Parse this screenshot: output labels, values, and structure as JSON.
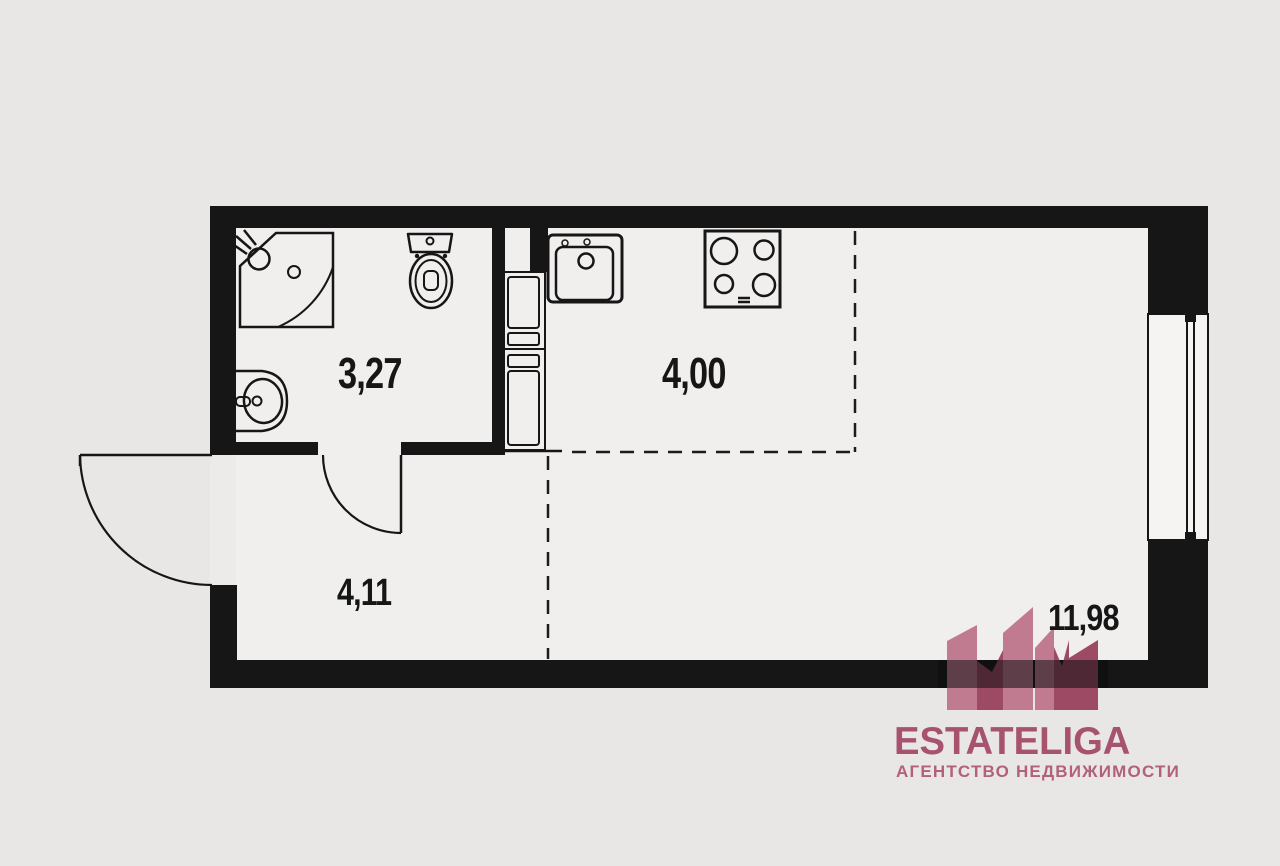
{
  "plan": {
    "title": "studio-apartment-floor-plan",
    "rooms": {
      "bathroom": {
        "area_label": "3,27"
      },
      "kitchen": {
        "area_label": "4,00"
      },
      "hallway": {
        "area_label": "4,11"
      },
      "living": {
        "area_label": "11,98"
      }
    },
    "fixtures": [
      "corner-shower",
      "pedestal-sink",
      "toilet",
      "laundry-closet",
      "kitchen-sink",
      "stove-4-burner",
      "window",
      "entry-door",
      "bathroom-door"
    ],
    "colors": {
      "wall": "#161616",
      "floor": "#f0efee",
      "background": "#e8e7e6",
      "line": "#1c1c1c"
    }
  },
  "logo": {
    "brand": "ESTATELIGA",
    "tagline": "АГЕНТСТВО НЕДВИЖИМОСТИ",
    "tower_light": "#c17b91",
    "tower_dark": "#9d4a65",
    "text_color": "#a75370"
  }
}
